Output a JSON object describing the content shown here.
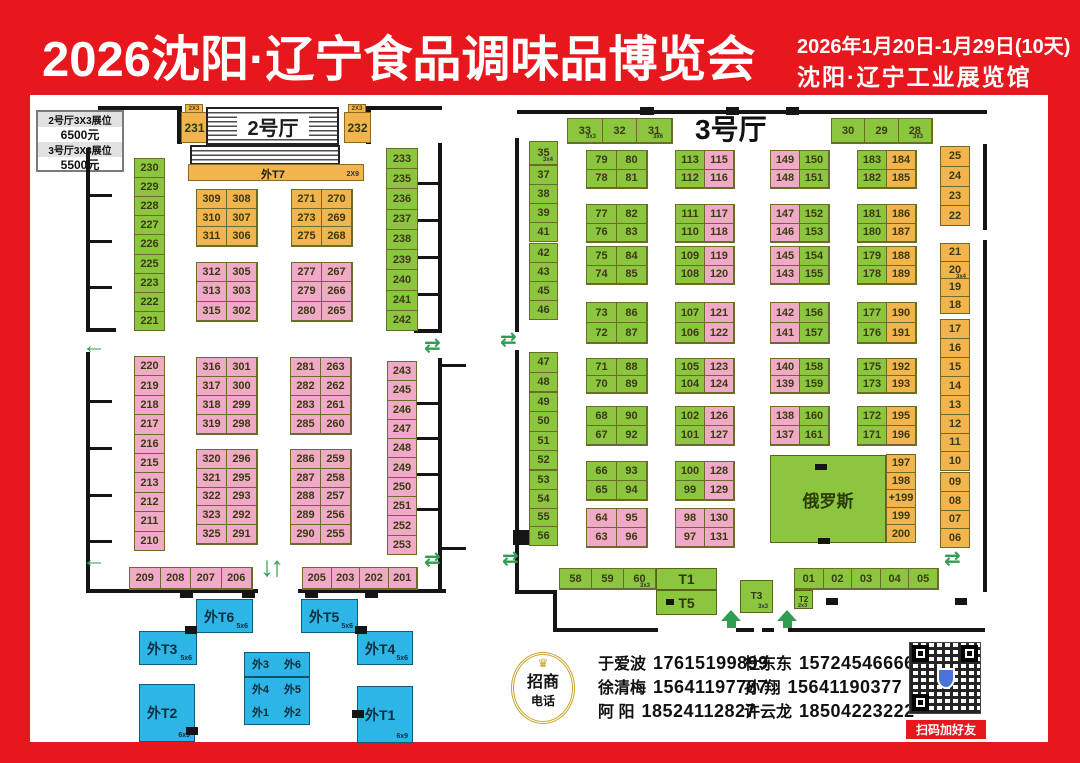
{
  "header": {
    "title": "2026沈阳·辽宁食品调味品博览会",
    "date_line": "2026年1月20日-1月29日(10天)",
    "venue_line": "沈阳·辽宁工业展览馆"
  },
  "price_box": {
    "row1_label": "2号厅3X3展位",
    "row1_price": "6500元",
    "row2_label": "3号厅3X3展位",
    "row2_price": "5500元"
  },
  "hall2": {
    "entrance_label": "2号厅",
    "booth231": "231",
    "booth232": "232",
    "t7_label": "外T7",
    "col_left_top": [
      "230",
      "229",
      "228",
      "227",
      "226",
      "225",
      "223",
      "222",
      "221"
    ],
    "col_right_top": [
      "233",
      "235",
      "236",
      "237",
      "238",
      "239",
      "240",
      "241",
      "242"
    ],
    "col_left_bottom": [
      "220",
      "219",
      "218",
      "217",
      "216",
      "215",
      "213",
      "212",
      "211",
      "210"
    ],
    "col_right_bottom": [
      "243",
      "245",
      "246",
      "247",
      "248",
      "249",
      "250",
      "251",
      "252",
      "253"
    ],
    "strip_left": {
      "color": "pink",
      "rows": [
        [
          "209",
          "208",
          "207",
          "206"
        ]
      ]
    },
    "strip_right": {
      "color": "pink",
      "rows": [
        [
          "205",
          "203",
          "202",
          "201"
        ]
      ]
    },
    "blocks": [
      {
        "color": "orange",
        "rows": [
          [
            "309",
            "308"
          ],
          [
            "310",
            "307"
          ],
          [
            "311",
            "306"
          ]
        ]
      },
      {
        "color": "orange",
        "rows": [
          [
            "271",
            "270"
          ],
          [
            "273",
            "269"
          ],
          [
            "275",
            "268"
          ]
        ]
      },
      {
        "color": "pink",
        "rows": [
          [
            "312",
            "305"
          ],
          [
            "313",
            "303"
          ],
          [
            "315",
            "302"
          ]
        ]
      },
      {
        "color": "pink",
        "rows": [
          [
            "277",
            "267"
          ],
          [
            "279",
            "266"
          ],
          [
            "280",
            "265"
          ]
        ]
      },
      {
        "color": "pink",
        "rows": [
          [
            "316",
            "301"
          ],
          [
            "317",
            "300"
          ],
          [
            "318",
            "299"
          ],
          [
            "319",
            "298"
          ]
        ]
      },
      {
        "color": "pink",
        "rows": [
          [
            "281",
            "263"
          ],
          [
            "282",
            "262"
          ],
          [
            "283",
            "261"
          ],
          [
            "285",
            "260"
          ]
        ]
      },
      {
        "color": "pink",
        "rows": [
          [
            "320",
            "296"
          ],
          [
            "321",
            "295"
          ],
          [
            "322",
            "293"
          ],
          [
            "323",
            "292"
          ],
          [
            "325",
            "291"
          ]
        ]
      },
      {
        "color": "pink",
        "rows": [
          [
            "286",
            "259"
          ],
          [
            "287",
            "258"
          ],
          [
            "288",
            "257"
          ],
          [
            "289",
            "256"
          ],
          [
            "290",
            "255"
          ]
        ]
      }
    ]
  },
  "hall3": {
    "name": "3号厅",
    "strip_top_left": {
      "color": "green",
      "rows": [
        [
          "33",
          "32",
          "31"
        ]
      ]
    },
    "strip_top_right": {
      "color": "green",
      "rows": [
        [
          "30",
          "29",
          "28"
        ]
      ]
    },
    "col_left_groups": [
      [
        "35"
      ],
      [
        "37",
        "38",
        "39",
        "41"
      ],
      [
        "42",
        "43",
        "45",
        "46"
      ],
      [
        "47",
        "48"
      ],
      [
        "49",
        "50",
        "51",
        "52"
      ],
      [
        "53",
        "54",
        "55",
        "56"
      ]
    ],
    "col_right_groups": [
      [
        "25",
        "24",
        "23",
        "22"
      ],
      [
        "21",
        "20",
        "19",
        "18"
      ],
      [
        "17",
        "16",
        "15",
        "14"
      ],
      [
        "13",
        "12",
        "11",
        "10"
      ],
      [
        "09",
        "08",
        "07",
        "06"
      ]
    ],
    "blocks": [
      {
        "lc": "green",
        "rc": "green",
        "rows": [
          [
            "79",
            "80"
          ],
          [
            "78",
            "81"
          ]
        ]
      },
      {
        "lc": "green",
        "rc": "green",
        "rows": [
          [
            "77",
            "82"
          ],
          [
            "76",
            "83"
          ]
        ]
      },
      {
        "lc": "green",
        "rc": "green",
        "rows": [
          [
            "75",
            "84"
          ],
          [
            "74",
            "85"
          ]
        ]
      },
      {
        "lc": "green",
        "rc": "green",
        "rows": [
          [
            "73",
            "86"
          ],
          [
            "72",
            "87"
          ]
        ]
      },
      {
        "lc": "green",
        "rc": "green",
        "rows": [
          [
            "71",
            "88"
          ],
          [
            "70",
            "89"
          ]
        ]
      },
      {
        "lc": "green",
        "rc": "green",
        "rows": [
          [
            "68",
            "90"
          ],
          [
            "67",
            "92"
          ]
        ]
      },
      {
        "lc": "green",
        "rc": "green",
        "rows": [
          [
            "66",
            "93"
          ],
          [
            "65",
            "94"
          ]
        ]
      },
      {
        "lc": "pink",
        "rc": "pink",
        "rows": [
          [
            "64",
            "95"
          ],
          [
            "63",
            "96"
          ]
        ]
      },
      {
        "lc": "green",
        "rc": "pink",
        "rows": [
          [
            "113",
            "115"
          ],
          [
            "112",
            "116"
          ]
        ]
      },
      {
        "lc": "green",
        "rc": "pink",
        "rows": [
          [
            "111",
            "117"
          ],
          [
            "110",
            "118"
          ]
        ]
      },
      {
        "lc": "green",
        "rc": "pink",
        "rows": [
          [
            "109",
            "119"
          ],
          [
            "108",
            "120"
          ]
        ]
      },
      {
        "lc": "green",
        "rc": "pink",
        "rows": [
          [
            "107",
            "121"
          ],
          [
            "106",
            "122"
          ]
        ]
      },
      {
        "lc": "green",
        "rc": "pink",
        "rows": [
          [
            "105",
            "123"
          ],
          [
            "104",
            "124"
          ]
        ]
      },
      {
        "lc": "green",
        "rc": "pink",
        "rows": [
          [
            "102",
            "126"
          ],
          [
            "101",
            "127"
          ]
        ]
      },
      {
        "lc": "green",
        "rc": "pink",
        "rows": [
          [
            "100",
            "128"
          ],
          [
            "99",
            "129"
          ]
        ]
      },
      {
        "lc": "pink",
        "rc": "pink",
        "rows": [
          [
            "98",
            "130"
          ],
          [
            "97",
            "131"
          ]
        ]
      },
      {
        "lc": "pink",
        "rc": "green",
        "rows": [
          [
            "149",
            "150"
          ],
          [
            "148",
            "151"
          ]
        ]
      },
      {
        "lc": "pink",
        "rc": "green",
        "rows": [
          [
            "147",
            "152"
          ],
          [
            "146",
            "153"
          ]
        ]
      },
      {
        "lc": "pink",
        "rc": "green",
        "rows": [
          [
            "145",
            "154"
          ],
          [
            "143",
            "155"
          ]
        ]
      },
      {
        "lc": "pink",
        "rc": "green",
        "rows": [
          [
            "142",
            "156"
          ],
          [
            "141",
            "157"
          ]
        ]
      },
      {
        "lc": "pink",
        "rc": "green",
        "rows": [
          [
            "140",
            "158"
          ],
          [
            "139",
            "159"
          ]
        ]
      },
      {
        "lc": "pink",
        "rc": "green",
        "rows": [
          [
            "138",
            "160"
          ],
          [
            "137",
            "161"
          ]
        ]
      },
      {
        "lc": "green",
        "rc": "orange",
        "rows": [
          [
            "183",
            "184"
          ],
          [
            "182",
            "185"
          ]
        ]
      },
      {
        "lc": "green",
        "rc": "orange",
        "rows": [
          [
            "181",
            "186"
          ],
          [
            "180",
            "187"
          ]
        ]
      },
      {
        "lc": "green",
        "rc": "orange",
        "rows": [
          [
            "179",
            "188"
          ],
          [
            "178",
            "189"
          ]
        ]
      },
      {
        "lc": "green",
        "rc": "orange",
        "rows": [
          [
            "177",
            "190"
          ],
          [
            "176",
            "191"
          ]
        ]
      },
      {
        "lc": "green",
        "rc": "orange",
        "rows": [
          [
            "175",
            "192"
          ],
          [
            "173",
            "193"
          ]
        ]
      },
      {
        "lc": "green",
        "rc": "orange",
        "rows": [
          [
            "172",
            "195"
          ],
          [
            "171",
            "196"
          ]
        ]
      }
    ],
    "russia_label": "俄罗斯",
    "russia_col": [
      "197",
      "198",
      "+199",
      "199",
      "200"
    ],
    "strip_58": {
      "color": "green",
      "rows": [
        [
          "58",
          "59",
          "60"
        ]
      ]
    },
    "strip_01": {
      "color": "green",
      "rows": [
        [
          "01",
          "02",
          "03",
          "04",
          "05"
        ]
      ]
    },
    "t1": "T1",
    "t5": "T5",
    "t3": "T3",
    "t2": "T2"
  },
  "outdoor": {
    "t6": "外T6",
    "t5": "外T5",
    "t4": "外T4",
    "t3": "外T3",
    "t2": "外T2",
    "t1": "外T1",
    "center": {
      "plain": true,
      "rows": [
        [
          "外3",
          "外6"
        ],
        [
          "外4",
          "外5"
        ],
        [
          "外1",
          "外2"
        ]
      ]
    }
  },
  "sizes": {
    "b231": "2X3",
    "b232": "2X3",
    "t7": "2X9",
    "b33": "3x3",
    "b31": "3x6",
    "b28": "3x3",
    "b35": "3x4",
    "b20": "3x4",
    "s60": "3x3",
    "t3": "3x3",
    "t2": "2x3",
    "wt6": "5x6",
    "wt5": "5x6",
    "wt4": "5x6",
    "wt3": "5x6",
    "wt2": "6x9",
    "wt1": "6x9"
  },
  "contacts": {
    "badge_top": "招商",
    "badge_bottom": "电话",
    "list": [
      {
        "name": "于爱波",
        "phone": "17615199899"
      },
      {
        "name": "徐清梅",
        "phone": "15641197787"
      },
      {
        "name": "阿  阳",
        "phone": "18524112827"
      },
      {
        "name": "杜东东",
        "phone": "15724546666"
      },
      {
        "name": "孙  翔",
        "phone": "15641190377"
      },
      {
        "name": "许云龙",
        "phone": "18504223222"
      }
    ],
    "qr_label": "扫码加好友"
  },
  "colors": {
    "green": "#8cc63f",
    "pink": "#f0a9c6",
    "orange": "#f2b44c",
    "cyan": "#2db5e6",
    "red": "#e7171d",
    "arrow": "#2f9e53"
  }
}
